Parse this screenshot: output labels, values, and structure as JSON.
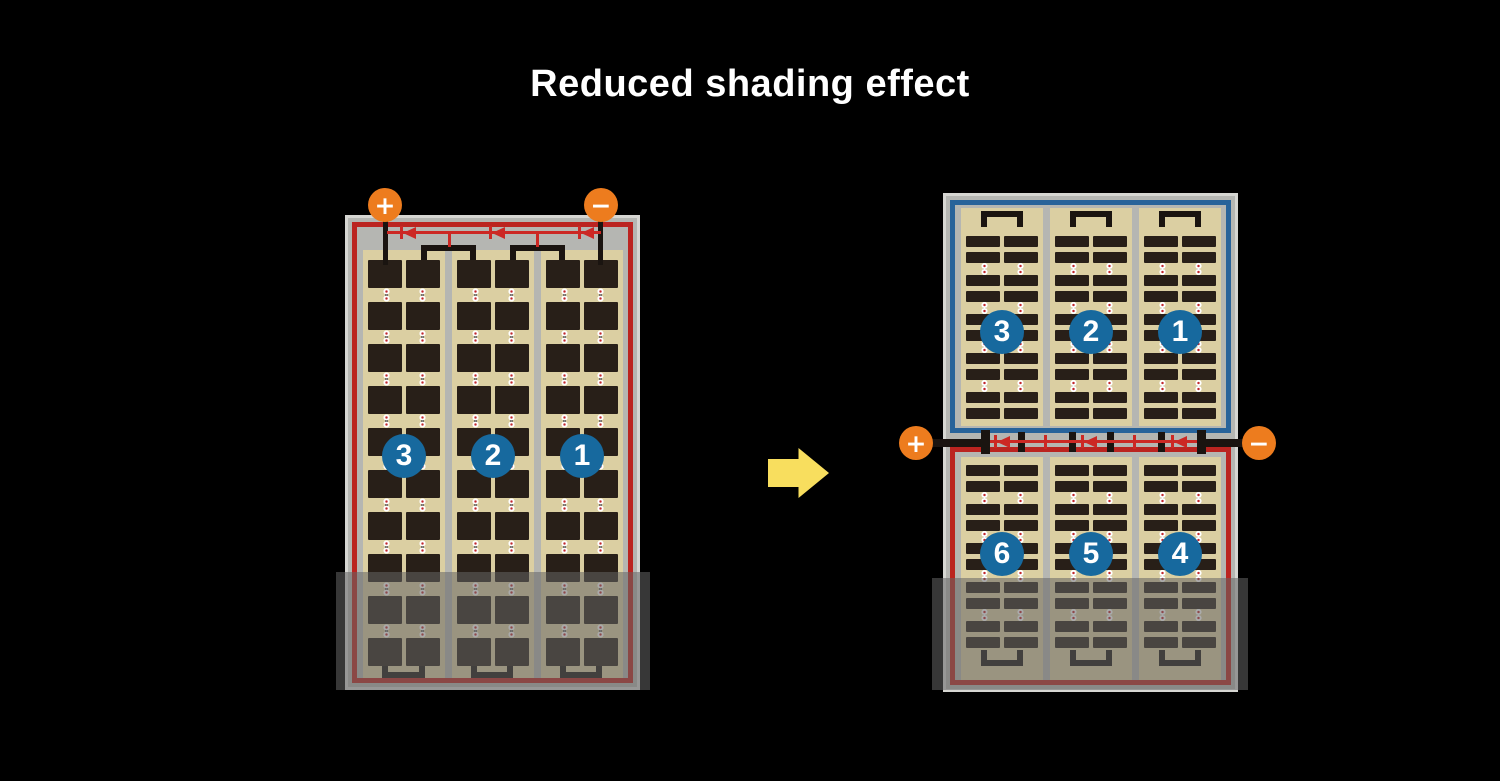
{
  "title": "Reduced shading effect",
  "colors": {
    "background": "#000000",
    "title_text": "#ffffff",
    "panel_frame": "#b5b6b2",
    "panel_frame_edge": "#d6d6d2",
    "cell_area": "#dbcfa2",
    "cell_dark": "#281f18",
    "wire_black": "#1a1410",
    "series_red": "#bb2420",
    "series_blue": "#28639a",
    "diode_red": "#cc2824",
    "terminal_orange": "#ed7c1e",
    "terminal_text": "#ffffff",
    "badge_blue": "#17699e",
    "badge_text": "#ffffff",
    "arrow_yellow": "#f8de5e",
    "solder_white": "#ffffff",
    "solder_red": "#c1272d",
    "shade_overlay": "rgba(100,100,100,0.55)"
  },
  "left_figure": {
    "positive_terminal": "+",
    "negative_terminal": "−",
    "badges": [
      "3",
      "2",
      "1"
    ]
  },
  "right_figure": {
    "positive_terminal": "+",
    "negative_terminal": "−",
    "top_badges": [
      "3",
      "2",
      "1"
    ],
    "bottom_badges": [
      "6",
      "5",
      "4"
    ]
  },
  "panels": {
    "left": {
      "columns": 3,
      "sub_columns": 2,
      "rows": 10,
      "cell_height": 28,
      "dot_gap": 14,
      "small_gap": 0,
      "dots_every": 1
    },
    "right_top": {
      "columns": 3,
      "sub_columns": 2,
      "rows": 10,
      "cell_height": 11,
      "dot_gap": 12,
      "small_gap": 5,
      "dots_every": 2
    },
    "right_bottom": {
      "columns": 3,
      "sub_columns": 2,
      "rows": 10,
      "cell_height": 11,
      "dot_gap": 12,
      "small_gap": 5,
      "dots_every": 2
    }
  }
}
